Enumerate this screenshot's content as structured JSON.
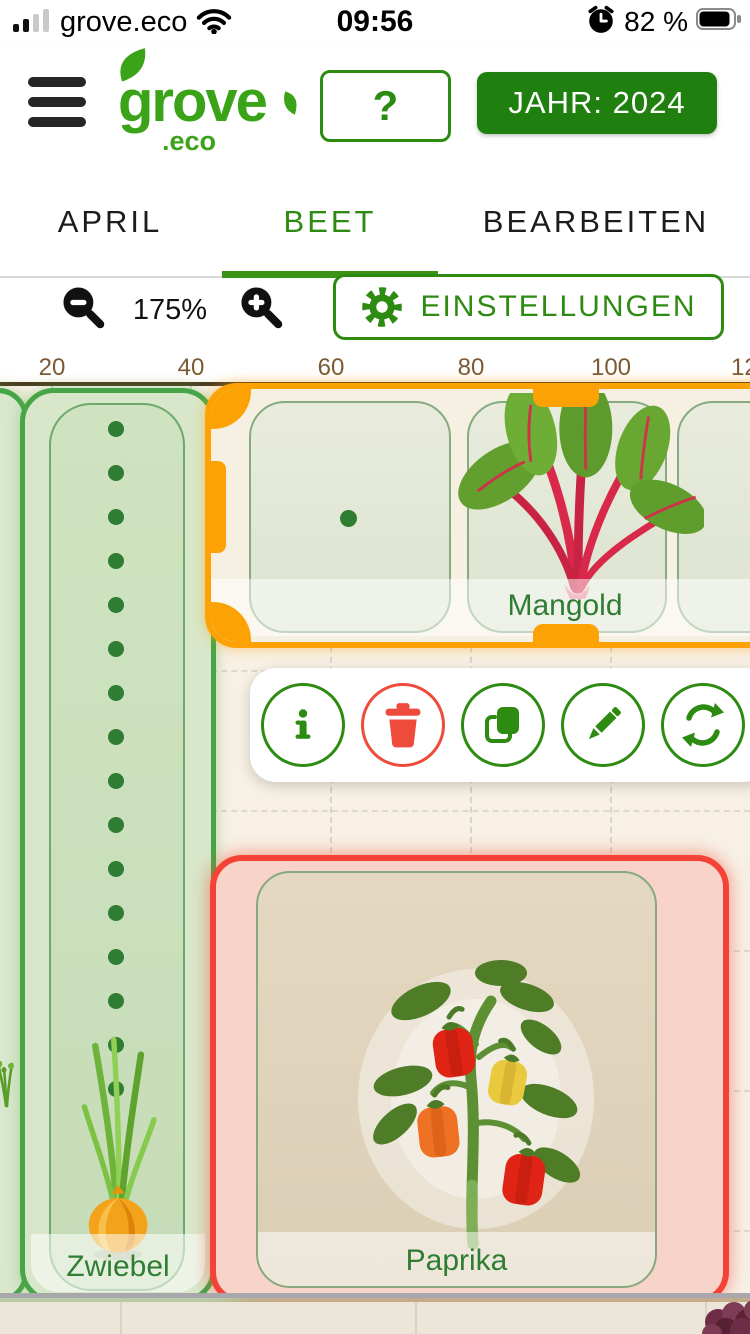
{
  "colors": {
    "brand_green": "#2e8b12",
    "dark_green_button": "#20800f",
    "selection_orange": "#fca204",
    "selection_red": "#f44336",
    "label_green": "#2e7d32",
    "delete_red": "#ef4b3d"
  },
  "status_bar": {
    "carrier": "grove.eco",
    "time": "09:56",
    "battery": "82 %"
  },
  "header": {
    "logo": "grove",
    "logo_tld": ".eco",
    "help": "?",
    "year": "JAHR: 2024"
  },
  "tabs": {
    "items": [
      {
        "label": "APRIL"
      },
      {
        "label": "BEET"
      },
      {
        "label": "BEARBEITEN"
      }
    ],
    "active": "BEET"
  },
  "controls": {
    "zoom": "175%",
    "settings": "EINSTELLUNGEN"
  },
  "ruler": {
    "ticks": [
      "20",
      "40",
      "60",
      "80",
      "100",
      "120"
    ]
  },
  "garden": {
    "beds": [
      {
        "id": "zwiebel",
        "label": "Zwiebel",
        "plant": "onion",
        "state": "default"
      },
      {
        "id": "mangold",
        "label": "Mangold",
        "plant": "chard",
        "state": "selected-orange"
      },
      {
        "id": "paprika",
        "label": "Paprika",
        "plant": "pepper",
        "state": "selected-red"
      }
    ]
  },
  "toolbar": {
    "buttons": [
      {
        "name": "info",
        "icon": "info-icon"
      },
      {
        "name": "delete",
        "icon": "trash-icon"
      },
      {
        "name": "duplicate",
        "icon": "copy-icon"
      },
      {
        "name": "edit",
        "icon": "pencil-icon"
      },
      {
        "name": "rotate",
        "icon": "rotate-icon"
      }
    ]
  }
}
